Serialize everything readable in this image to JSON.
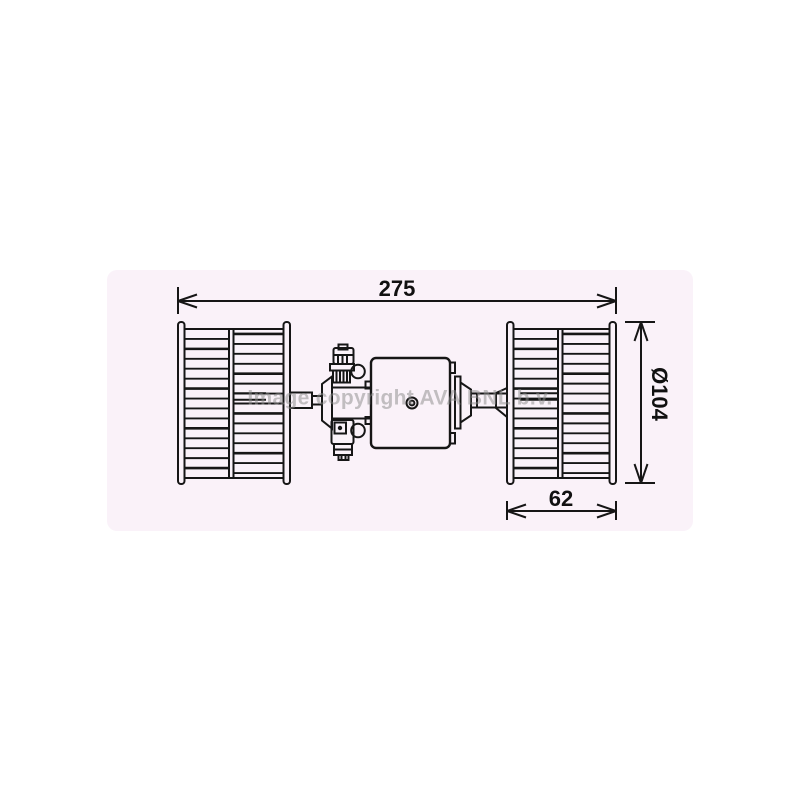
{
  "canvas": {
    "background": "#ffffff"
  },
  "panel": {
    "background": "#faf2f9",
    "line_color": "#161616"
  },
  "watermark": {
    "text": "Image copyright AVA BNL b.v.",
    "color": "#8c8c8c"
  },
  "dimensions": {
    "total_width": {
      "label": "275"
    },
    "diameter": {
      "label": "Ø104"
    },
    "fan_width": {
      "label": "62"
    }
  }
}
